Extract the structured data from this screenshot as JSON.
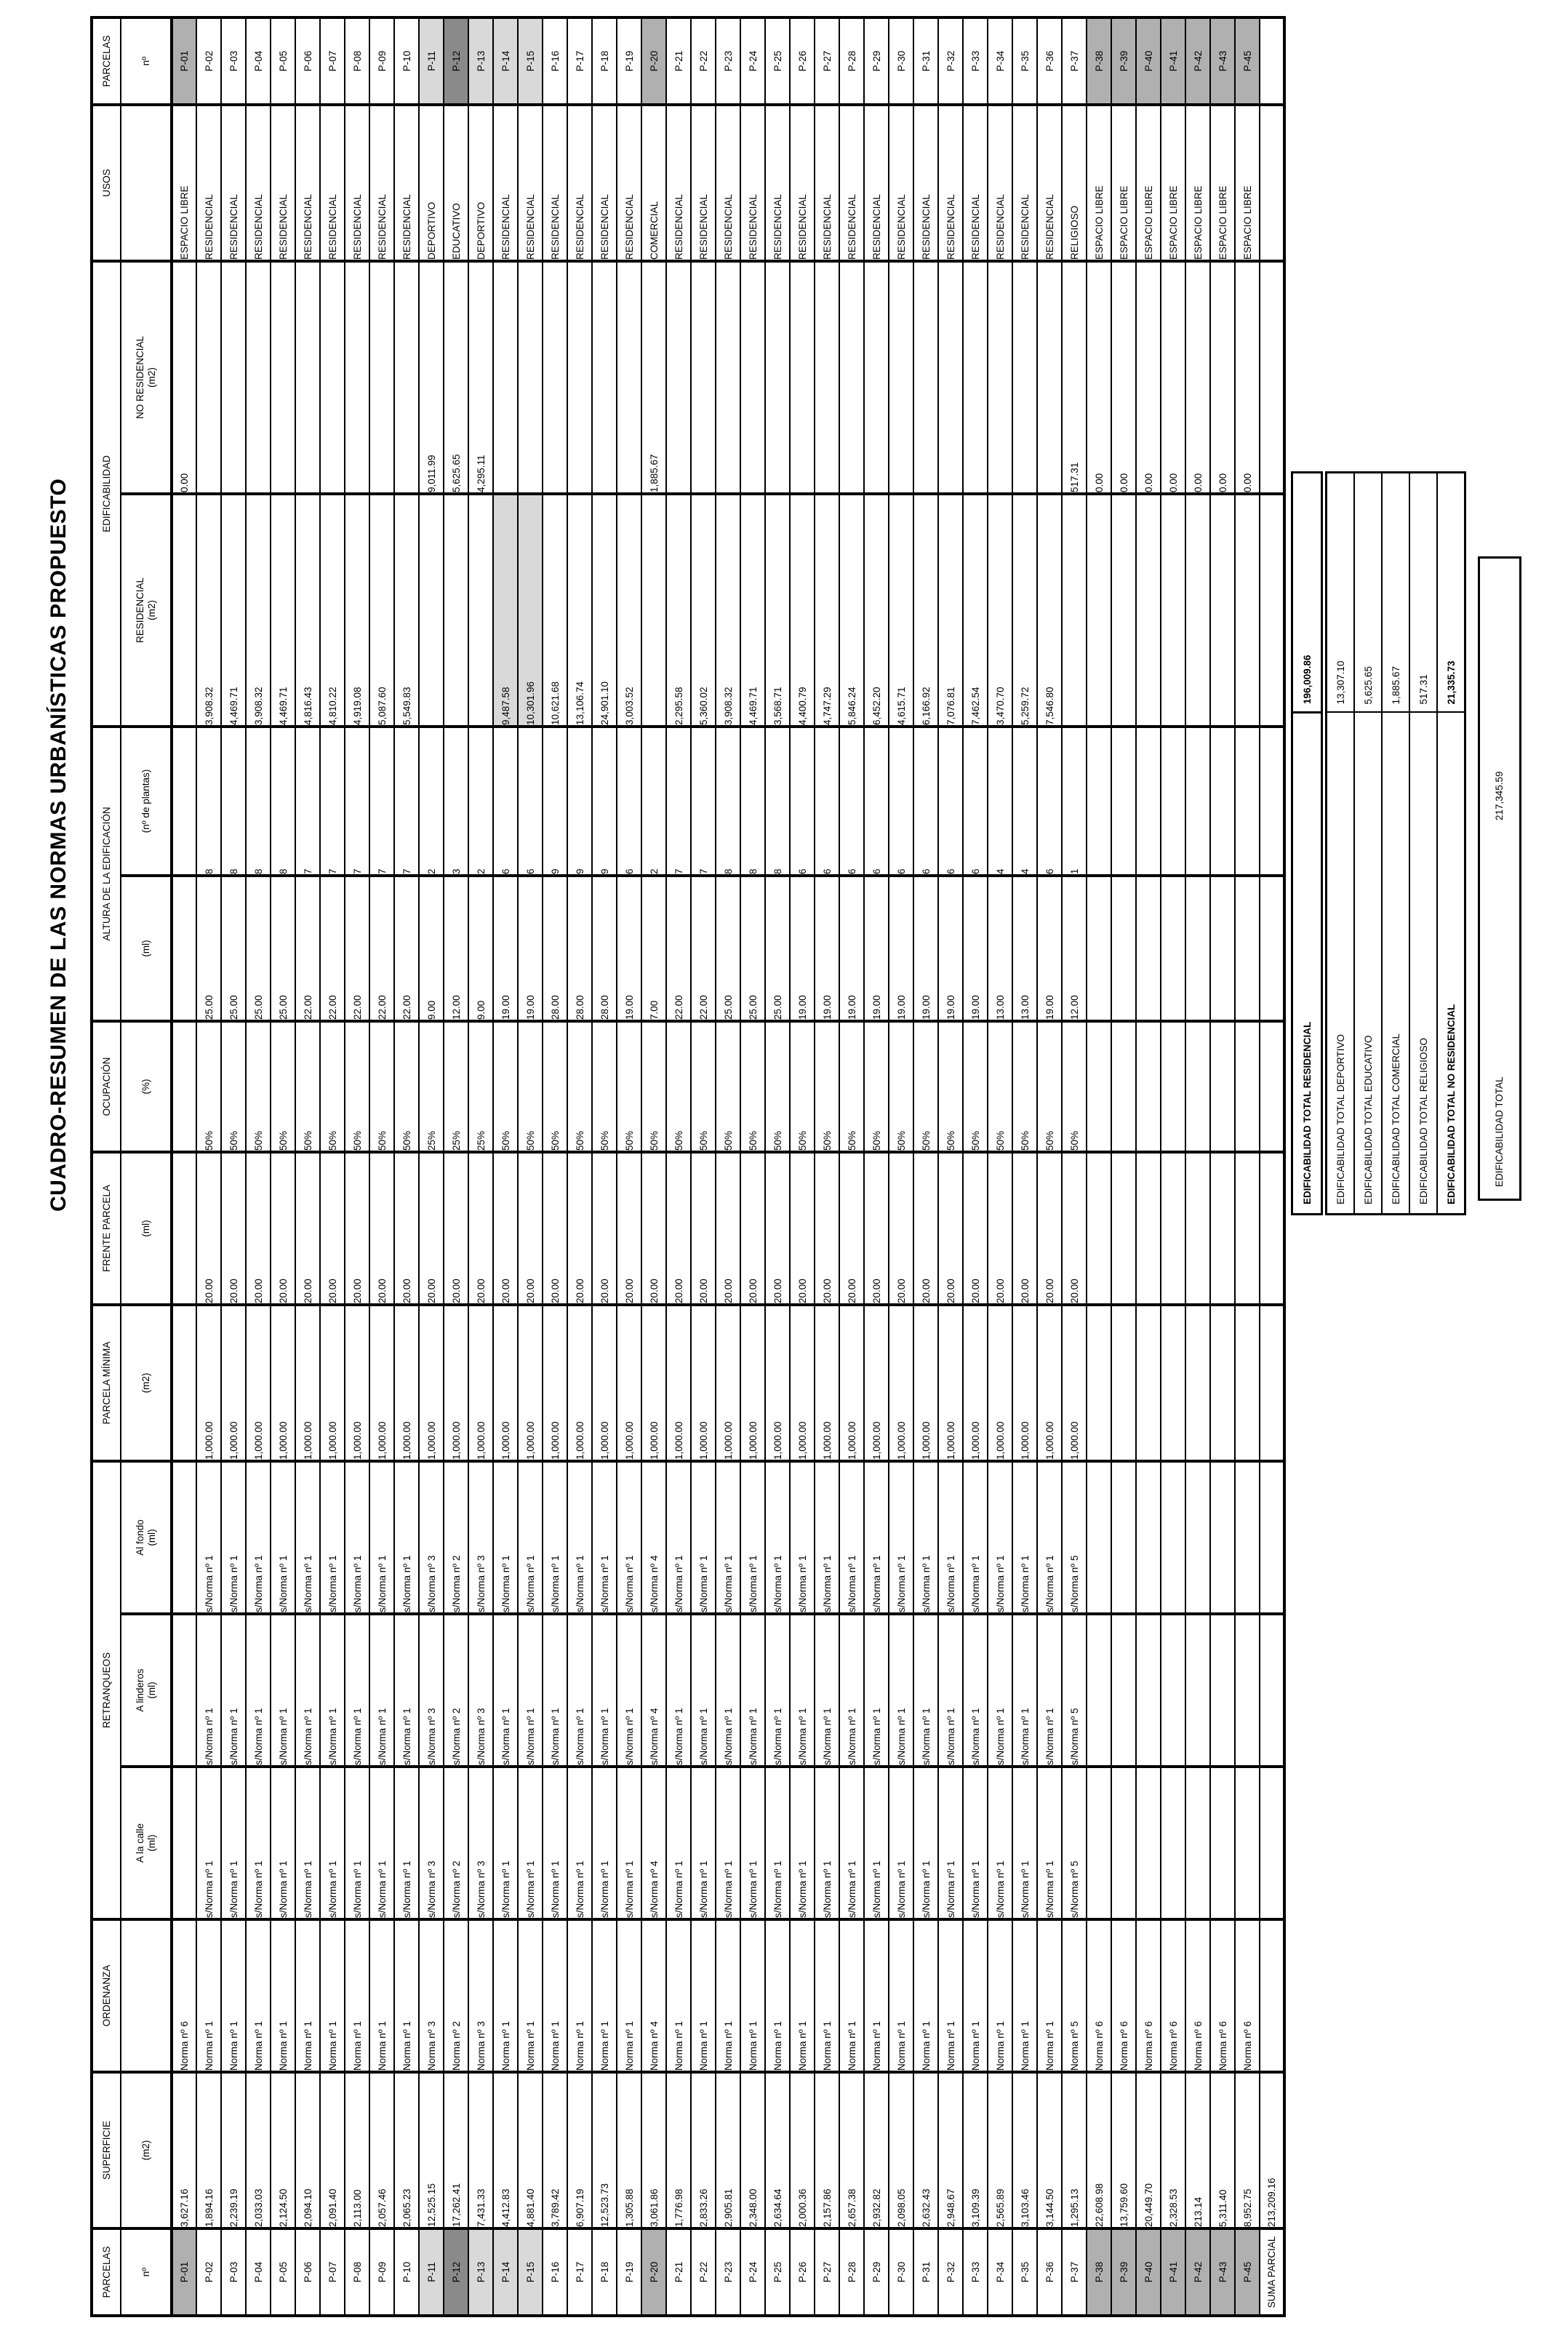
{
  "title": "CUADRO-RESUMEN DE LAS NORMAS URBANÍSTICAS PROPUESTO",
  "colors": {
    "shade_light": "#d9d9d9",
    "shade_mid": "#b0b0b0",
    "shade_dark": "#8a8a8a",
    "border": "#000000"
  },
  "table": {
    "headers": {
      "parcelas": "PARCELAS",
      "superficie": "SUPERFICIE",
      "ordenanza": "ORDENANZA",
      "retranqueos": "RETRANQUEOS",
      "parcela_minima": "PARCELA MÍNIMA",
      "frente_parcela": "FRENTE PARCELA",
      "ocupacion": "OCUPACIÓN",
      "altura": "ALTURA DE LA EDIFICACIÓN",
      "edificabilidad": "EDIFICABILIDAD",
      "usos": "USOS",
      "sub_no": "nº",
      "sub_m2": "(m2)",
      "sub_ml": "(ml)",
      "sub_pct": "(%)",
      "sub_plantas": "(nº de plantas)",
      "sub_calle": "A la calle",
      "sub_linderos": "A linderos",
      "sub_fondo": "Al fondo",
      "sub_residencial": "RESIDENCIAL",
      "sub_no_residencial": "NO RESIDENCIAL"
    },
    "rows": [
      {
        "no": "P-01",
        "sup": "3,627.16",
        "ord": "Norma nº 6",
        "rc": "",
        "rl": "",
        "rf": "",
        "pm": "",
        "fp": "",
        "oc": "",
        "ml": "",
        "pl": "",
        "res": "",
        "nores": "0.00",
        "uso": "ESPACIO LIBRE",
        "shade": "mid"
      },
      {
        "no": "P-02",
        "sup": "1,894.16",
        "ord": "Norma nº 1",
        "rc": "s/Norma nº 1",
        "rl": "s/Norma nº 1",
        "rf": "s/Norma nº 1",
        "pm": "1,000.00",
        "fp": "20.00",
        "oc": "50%",
        "ml": "25.00",
        "pl": "8",
        "res": "3,908.32",
        "nores": "",
        "uso": "RESIDENCIAL"
      },
      {
        "no": "P-03",
        "sup": "2,239.19",
        "ord": "Norma nº 1",
        "rc": "s/Norma nº 1",
        "rl": "s/Norma nº 1",
        "rf": "s/Norma nº 1",
        "pm": "1,000.00",
        "fp": "20.00",
        "oc": "50%",
        "ml": "25.00",
        "pl": "8",
        "res": "4,469.71",
        "nores": "",
        "uso": "RESIDENCIAL"
      },
      {
        "no": "P-04",
        "sup": "2,033.03",
        "ord": "Norma nº 1",
        "rc": "s/Norma nº 1",
        "rl": "s/Norma nº 1",
        "rf": "s/Norma nº 1",
        "pm": "1,000.00",
        "fp": "20.00",
        "oc": "50%",
        "ml": "25.00",
        "pl": "8",
        "res": "3,908.32",
        "nores": "",
        "uso": "RESIDENCIAL"
      },
      {
        "no": "P-05",
        "sup": "2,124.50",
        "ord": "Norma nº 1",
        "rc": "s/Norma nº 1",
        "rl": "s/Norma nº 1",
        "rf": "s/Norma nº 1",
        "pm": "1,000.00",
        "fp": "20.00",
        "oc": "50%",
        "ml": "25.00",
        "pl": "8",
        "res": "4,469.71",
        "nores": "",
        "uso": "RESIDENCIAL"
      },
      {
        "no": "P-06",
        "sup": "2,094.10",
        "ord": "Norma nº 1",
        "rc": "s/Norma nº 1",
        "rl": "s/Norma nº 1",
        "rf": "s/Norma nº 1",
        "pm": "1,000.00",
        "fp": "20.00",
        "oc": "50%",
        "ml": "22.00",
        "pl": "7",
        "res": "4,816.43",
        "nores": "",
        "uso": "RESIDENCIAL"
      },
      {
        "no": "P-07",
        "sup": "2,091.40",
        "ord": "Norma nº 1",
        "rc": "s/Norma nº 1",
        "rl": "s/Norma nº 1",
        "rf": "s/Norma nº 1",
        "pm": "1,000.00",
        "fp": "20.00",
        "oc": "50%",
        "ml": "22.00",
        "pl": "7",
        "res": "4,810.22",
        "nores": "",
        "uso": "RESIDENCIAL"
      },
      {
        "no": "P-08",
        "sup": "2,113.00",
        "ord": "Norma nº 1",
        "rc": "s/Norma nº 1",
        "rl": "s/Norma nº 1",
        "rf": "s/Norma nº 1",
        "pm": "1,000.00",
        "fp": "20.00",
        "oc": "50%",
        "ml": "22.00",
        "pl": "7",
        "res": "4,919.08",
        "nores": "",
        "uso": "RESIDENCIAL"
      },
      {
        "no": "P-09",
        "sup": "2,057.46",
        "ord": "Norma nº 1",
        "rc": "s/Norma nº 1",
        "rl": "s/Norma nº 1",
        "rf": "s/Norma nº 1",
        "pm": "1,000.00",
        "fp": "20.00",
        "oc": "50%",
        "ml": "22.00",
        "pl": "7",
        "res": "5,087.60",
        "nores": "",
        "uso": "RESIDENCIAL"
      },
      {
        "no": "P-10",
        "sup": "2,065.23",
        "ord": "Norma nº 1",
        "rc": "s/Norma nº 1",
        "rl": "s/Norma nº 1",
        "rf": "s/Norma nº 1",
        "pm": "1,000.00",
        "fp": "20.00",
        "oc": "50%",
        "ml": "22.00",
        "pl": "7",
        "res": "5,549.83",
        "nores": "",
        "uso": "RESIDENCIAL"
      },
      {
        "no": "P-11",
        "sup": "12,525.15",
        "ord": "Norma nº 3",
        "rc": "s/Norma nº 3",
        "rl": "s/Norma nº 3",
        "rf": "s/Norma nº 3",
        "pm": "1,000.00",
        "fp": "20.00",
        "oc": "25%",
        "ml": "9.00",
        "pl": "2",
        "res": "",
        "nores": "9,011.99",
        "uso": "DEPORTIVO",
        "shade": "light"
      },
      {
        "no": "P-12",
        "sup": "17,262.41",
        "ord": "Norma nº 2",
        "rc": "s/Norma nº 2",
        "rl": "s/Norma nº 2",
        "rf": "s/Norma nº 2",
        "pm": "1,000.00",
        "fp": "20.00",
        "oc": "25%",
        "ml": "12.00",
        "pl": "3",
        "res": "",
        "nores": "5,625.65",
        "uso": "EDUCATIVO",
        "shade": "dark"
      },
      {
        "no": "P-13",
        "sup": "7,431.33",
        "ord": "Norma nº 3",
        "rc": "s/Norma nº 3",
        "rl": "s/Norma nº 3",
        "rf": "s/Norma nº 3",
        "pm": "1,000.00",
        "fp": "20.00",
        "oc": "25%",
        "ml": "9.00",
        "pl": "2",
        "res": "",
        "nores": "4,295.11",
        "uso": "DEPORTIVO",
        "shade": "light"
      },
      {
        "no": "P-14",
        "sup": "4,412.83",
        "ord": "Norma nº 1",
        "rc": "s/Norma nº 1",
        "rl": "s/Norma nº 1",
        "rf": "s/Norma nº 1",
        "pm": "1,000.00",
        "fp": "20.00",
        "oc": "50%",
        "ml": "19.00",
        "pl": "6",
        "res": "9,487.58",
        "nores": "",
        "uso": "RESIDENCIAL",
        "shade": "light",
        "res_shade": true
      },
      {
        "no": "P-15",
        "sup": "4,881.40",
        "ord": "Norma nº 1",
        "rc": "s/Norma nº 1",
        "rl": "s/Norma nº 1",
        "rf": "s/Norma nº 1",
        "pm": "1,000.00",
        "fp": "20.00",
        "oc": "50%",
        "ml": "19.00",
        "pl": "6",
        "res": "10,301.96",
        "nores": "",
        "uso": "RESIDENCIAL",
        "shade": "light",
        "res_shade": true
      },
      {
        "no": "P-16",
        "sup": "3,789.42",
        "ord": "Norma nº 1",
        "rc": "s/Norma nº 1",
        "rl": "s/Norma nº 1",
        "rf": "s/Norma nº 1",
        "pm": "1,000.00",
        "fp": "20.00",
        "oc": "50%",
        "ml": "28.00",
        "pl": "9",
        "res": "10,621.68",
        "nores": "",
        "uso": "RESIDENCIAL"
      },
      {
        "no": "P-17",
        "sup": "6,907.19",
        "ord": "Norma nº 1",
        "rc": "s/Norma nº 1",
        "rl": "s/Norma nº 1",
        "rf": "s/Norma nº 1",
        "pm": "1,000.00",
        "fp": "20.00",
        "oc": "50%",
        "ml": "28.00",
        "pl": "9",
        "res": "13,106.74",
        "nores": "",
        "uso": "RESIDENCIAL"
      },
      {
        "no": "P-18",
        "sup": "12,523.73",
        "ord": "Norma nº 1",
        "rc": "s/Norma nº 1",
        "rl": "s/Norma nº 1",
        "rf": "s/Norma nº 1",
        "pm": "1,000.00",
        "fp": "20.00",
        "oc": "50%",
        "ml": "28.00",
        "pl": "9",
        "res": "24,901.10",
        "nores": "",
        "uso": "RESIDENCIAL"
      },
      {
        "no": "P-19",
        "sup": "1,305.88",
        "ord": "Norma nº 1",
        "rc": "s/Norma nº 1",
        "rl": "s/Norma nº 1",
        "rf": "s/Norma nº 1",
        "pm": "1,000.00",
        "fp": "20.00",
        "oc": "50%",
        "ml": "19.00",
        "pl": "6",
        "res": "3,003.52",
        "nores": "",
        "uso": "RESIDENCIAL"
      },
      {
        "no": "P-20",
        "sup": "3,061.86",
        "ord": "Norma nº 4",
        "rc": "s/Norma nº 4",
        "rl": "s/Norma nº 4",
        "rf": "s/Norma nº 4",
        "pm": "1,000.00",
        "fp": "20.00",
        "oc": "50%",
        "ml": "7.00",
        "pl": "2",
        "res": "",
        "nores": "1,885.67",
        "uso": "COMERCIAL",
        "shade": "mid"
      },
      {
        "no": "P-21",
        "sup": "1,776.98",
        "ord": "Norma nº 1",
        "rc": "s/Norma nº 1",
        "rl": "s/Norma nº 1",
        "rf": "s/Norma nº 1",
        "pm": "1,000.00",
        "fp": "20.00",
        "oc": "50%",
        "ml": "22.00",
        "pl": "7",
        "res": "2,295.58",
        "nores": "",
        "uso": "RESIDENCIAL"
      },
      {
        "no": "P-22",
        "sup": "2,833.26",
        "ord": "Norma nº 1",
        "rc": "s/Norma nº 1",
        "rl": "s/Norma nº 1",
        "rf": "s/Norma nº 1",
        "pm": "1,000.00",
        "fp": "20.00",
        "oc": "50%",
        "ml": "22.00",
        "pl": "7",
        "res": "5,360.02",
        "nores": "",
        "uso": "RESIDENCIAL"
      },
      {
        "no": "P-23",
        "sup": "2,905.81",
        "ord": "Norma nº 1",
        "rc": "s/Norma nº 1",
        "rl": "s/Norma nº 1",
        "rf": "s/Norma nº 1",
        "pm": "1,000.00",
        "fp": "20.00",
        "oc": "50%",
        "ml": "25.00",
        "pl": "8",
        "res": "3,908.32",
        "nores": "",
        "uso": "RESIDENCIAL"
      },
      {
        "no": "P-24",
        "sup": "2,348.00",
        "ord": "Norma nº 1",
        "rc": "s/Norma nº 1",
        "rl": "s/Norma nº 1",
        "rf": "s/Norma nº 1",
        "pm": "1,000.00",
        "fp": "20.00",
        "oc": "50%",
        "ml": "25.00",
        "pl": "8",
        "res": "4,469.71",
        "nores": "",
        "uso": "RESIDENCIAL"
      },
      {
        "no": "P-25",
        "sup": "2,634.64",
        "ord": "Norma nº 1",
        "rc": "s/Norma nº 1",
        "rl": "s/Norma nº 1",
        "rf": "s/Norma nº 1",
        "pm": "1,000.00",
        "fp": "20.00",
        "oc": "50%",
        "ml": "25.00",
        "pl": "8",
        "res": "3,568.71",
        "nores": "",
        "uso": "RESIDENCIAL"
      },
      {
        "no": "P-26",
        "sup": "2,000.36",
        "ord": "Norma nº 1",
        "rc": "s/Norma nº 1",
        "rl": "s/Norma nº 1",
        "rf": "s/Norma nº 1",
        "pm": "1,000.00",
        "fp": "20.00",
        "oc": "50%",
        "ml": "19.00",
        "pl": "6",
        "res": "4,400.79",
        "nores": "",
        "uso": "RESIDENCIAL"
      },
      {
        "no": "P-27",
        "sup": "2,157.86",
        "ord": "Norma nº 1",
        "rc": "s/Norma nº 1",
        "rl": "s/Norma nº 1",
        "rf": "s/Norma nº 1",
        "pm": "1,000.00",
        "fp": "20.00",
        "oc": "50%",
        "ml": "19.00",
        "pl": "6",
        "res": "4,747.29",
        "nores": "",
        "uso": "RESIDENCIAL"
      },
      {
        "no": "P-28",
        "sup": "2,657.38",
        "ord": "Norma nº 1",
        "rc": "s/Norma nº 1",
        "rl": "s/Norma nº 1",
        "rf": "s/Norma nº 1",
        "pm": "1,000.00",
        "fp": "20.00",
        "oc": "50%",
        "ml": "19.00",
        "pl": "6",
        "res": "5,846.24",
        "nores": "",
        "uso": "RESIDENCIAL"
      },
      {
        "no": "P-29",
        "sup": "2,932.82",
        "ord": "Norma nº 1",
        "rc": "s/Norma nº 1",
        "rl": "s/Norma nº 1",
        "rf": "s/Norma nº 1",
        "pm": "1,000.00",
        "fp": "20.00",
        "oc": "50%",
        "ml": "19.00",
        "pl": "6",
        "res": "6,452.20",
        "nores": "",
        "uso": "RESIDENCIAL"
      },
      {
        "no": "P-30",
        "sup": "2,098.05",
        "ord": "Norma nº 1",
        "rc": "s/Norma nº 1",
        "rl": "s/Norma nº 1",
        "rf": "s/Norma nº 1",
        "pm": "1,000.00",
        "fp": "20.00",
        "oc": "50%",
        "ml": "19.00",
        "pl": "6",
        "res": "4,615.71",
        "nores": "",
        "uso": "RESIDENCIAL"
      },
      {
        "no": "P-31",
        "sup": "2,632.43",
        "ord": "Norma nº 1",
        "rc": "s/Norma nº 1",
        "rl": "s/Norma nº 1",
        "rf": "s/Norma nº 1",
        "pm": "1,000.00",
        "fp": "20.00",
        "oc": "50%",
        "ml": "19.00",
        "pl": "6",
        "res": "6,166.92",
        "nores": "",
        "uso": "RESIDENCIAL"
      },
      {
        "no": "P-32",
        "sup": "2,948.67",
        "ord": "Norma nº 1",
        "rc": "s/Norma nº 1",
        "rl": "s/Norma nº 1",
        "rf": "s/Norma nº 1",
        "pm": "1,000.00",
        "fp": "20.00",
        "oc": "50%",
        "ml": "19.00",
        "pl": "6",
        "res": "7,076.81",
        "nores": "",
        "uso": "RESIDENCIAL"
      },
      {
        "no": "P-33",
        "sup": "3,109.39",
        "ord": "Norma nº 1",
        "rc": "s/Norma nº 1",
        "rl": "s/Norma nº 1",
        "rf": "s/Norma nº 1",
        "pm": "1,000.00",
        "fp": "20.00",
        "oc": "50%",
        "ml": "19.00",
        "pl": "6",
        "res": "7,462.54",
        "nores": "",
        "uso": "RESIDENCIAL"
      },
      {
        "no": "P-34",
        "sup": "2,565.89",
        "ord": "Norma nº 1",
        "rc": "s/Norma nº 1",
        "rl": "s/Norma nº 1",
        "rf": "s/Norma nº 1",
        "pm": "1,000.00",
        "fp": "20.00",
        "oc": "50%",
        "ml": "13.00",
        "pl": "4",
        "res": "3,470.70",
        "nores": "",
        "uso": "RESIDENCIAL"
      },
      {
        "no": "P-35",
        "sup": "3,103.46",
        "ord": "Norma nº 1",
        "rc": "s/Norma nº 1",
        "rl": "s/Norma nº 1",
        "rf": "s/Norma nº 1",
        "pm": "1,000.00",
        "fp": "20.00",
        "oc": "50%",
        "ml": "13.00",
        "pl": "4",
        "res": "5,259.72",
        "nores": "",
        "uso": "RESIDENCIAL"
      },
      {
        "no": "P-36",
        "sup": "3,144.50",
        "ord": "Norma nº 1",
        "rc": "s/Norma nº 1",
        "rl": "s/Norma nº 1",
        "rf": "s/Norma nº 1",
        "pm": "1,000.00",
        "fp": "20.00",
        "oc": "50%",
        "ml": "19.00",
        "pl": "6",
        "res": "7,546.80",
        "nores": "",
        "uso": "RESIDENCIAL"
      },
      {
        "no": "P-37",
        "sup": "1,295.13",
        "ord": "Norma nº 5",
        "rc": "s/Norma nº 5",
        "rl": "s/Norma nº 5",
        "rf": "s/Norma nº 5",
        "pm": "1,000.00",
        "fp": "20.00",
        "oc": "50%",
        "ml": "12.00",
        "pl": "1",
        "res": "",
        "nores": "517.31",
        "uso": "RELIGIOSO"
      },
      {
        "no": "P-38",
        "sup": "22,608.98",
        "ord": "Norma nº 6",
        "rc": "",
        "rl": "",
        "rf": "",
        "pm": "",
        "fp": "",
        "oc": "",
        "ml": "",
        "pl": "",
        "res": "",
        "nores": "0.00",
        "uso": "ESPACIO LIBRE",
        "shade": "mid"
      },
      {
        "no": "P-39",
        "sup": "13,759.60",
        "ord": "Norma nº 6",
        "rc": "",
        "rl": "",
        "rf": "",
        "pm": "",
        "fp": "",
        "oc": "",
        "ml": "",
        "pl": "",
        "res": "",
        "nores": "0.00",
        "uso": "ESPACIO LIBRE",
        "shade": "mid"
      },
      {
        "no": "P-40",
        "sup": "20,449.70",
        "ord": "Norma nº 6",
        "rc": "",
        "rl": "",
        "rf": "",
        "pm": "",
        "fp": "",
        "oc": "",
        "ml": "",
        "pl": "",
        "res": "",
        "nores": "0.00",
        "uso": "ESPACIO LIBRE",
        "shade": "mid"
      },
      {
        "no": "P-41",
        "sup": "2,328.53",
        "ord": "Norma nº 6",
        "rc": "",
        "rl": "",
        "rf": "",
        "pm": "",
        "fp": "",
        "oc": "",
        "ml": "",
        "pl": "",
        "res": "",
        "nores": "0.00",
        "uso": "ESPACIO LIBRE",
        "shade": "mid"
      },
      {
        "no": "P-42",
        "sup": "213.14",
        "ord": "Norma nº 6",
        "rc": "",
        "rl": "",
        "rf": "",
        "pm": "",
        "fp": "",
        "oc": "",
        "ml": "",
        "pl": "",
        "res": "",
        "nores": "0.00",
        "uso": "ESPACIO LIBRE",
        "shade": "mid"
      },
      {
        "no": "P-43",
        "sup": "5,311.40",
        "ord": "Norma nº 6",
        "rc": "",
        "rl": "",
        "rf": "",
        "pm": "",
        "fp": "",
        "oc": "",
        "ml": "",
        "pl": "",
        "res": "",
        "nores": "0.00",
        "uso": "ESPACIO LIBRE",
        "shade": "mid"
      },
      {
        "no": "P-45",
        "sup": "8,952.75",
        "ord": "Norma nº 6",
        "rc": "",
        "rl": "",
        "rf": "",
        "pm": "",
        "fp": "",
        "oc": "",
        "ml": "",
        "pl": "",
        "res": "",
        "nores": "0.00",
        "uso": "ESPACIO LIBRE",
        "shade": "mid"
      },
      {
        "no": "SUMA PARCIAL",
        "no2": "",
        "sup": "213,209.16",
        "ord": "",
        "rc": "",
        "rl": "",
        "rf": "",
        "pm": "",
        "fp": "",
        "oc": "",
        "ml": "",
        "pl": "",
        "res": "",
        "nores": "",
        "uso": "",
        "bold": true
      }
    ]
  },
  "summary": {
    "residencial_label": "EDIFICABILIDAD TOTAL RESIDENCIAL",
    "residencial_value": "196,009.86",
    "block": [
      {
        "label": "EDIFICABILIDAD TOTAL DEPORTIVO",
        "value": "13,307.10",
        "bold": false
      },
      {
        "label": "EDIFICABILIDAD TOTAL EDUCATIVO",
        "value": "5,625.65",
        "bold": false
      },
      {
        "label": "EDIFICABILIDAD TOTAL COMERCIAL",
        "value": "1,885.67",
        "bold": false
      },
      {
        "label": "EDIFICABILIDAD TOTAL RELIGIOSO",
        "value": "517.31",
        "bold": false
      },
      {
        "label": "EDIFICABILIDAD TOTAL NO RESIDENCIAL",
        "value": "21,335.73",
        "bold": true
      }
    ],
    "total_label": "EDIFICABILIDAD TOTAL",
    "total_value": "217,345.59"
  }
}
